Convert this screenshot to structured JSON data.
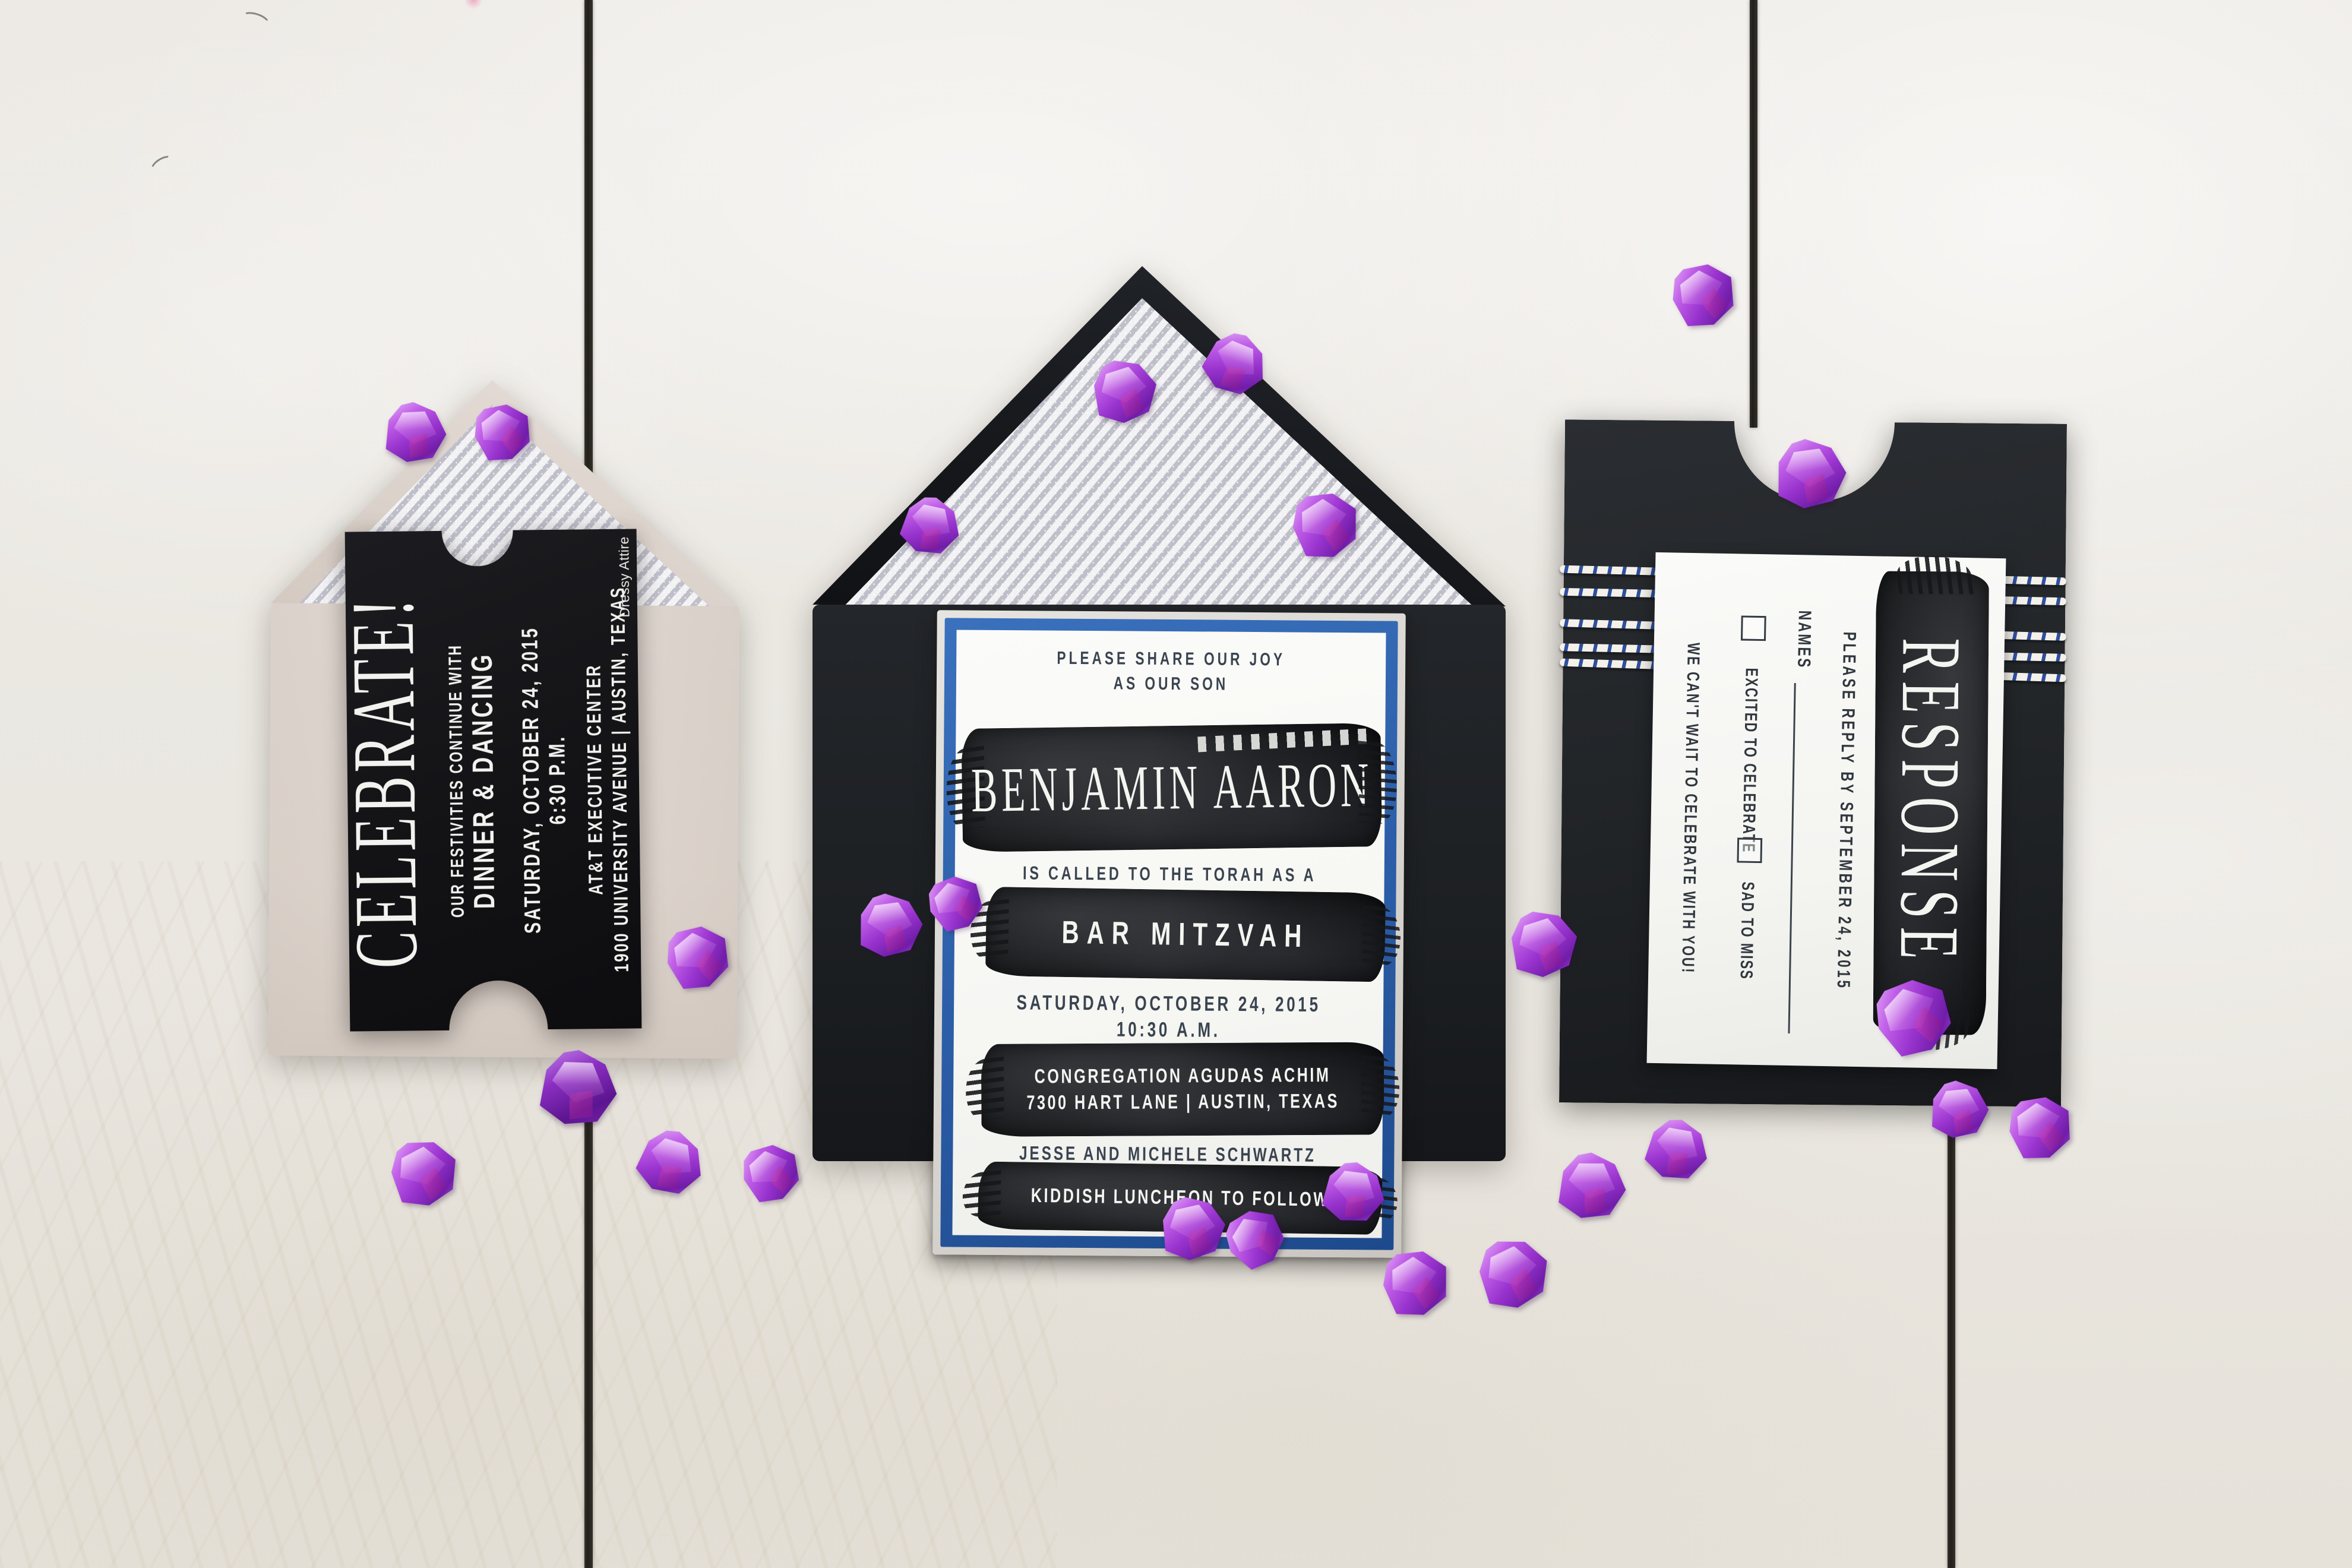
{
  "celebrate_card": {
    "title": "CELEBRATE!",
    "line1": "OUR FESTIVITIES CONTINUE WITH",
    "line2": "DINNER & DANCING",
    "line3": "SATURDAY, OCTOBER 24, 2015",
    "line4": "6:30 P.M.",
    "line5": "AT&T EXECUTIVE CENTER",
    "line6": "1900 UNIVERSITY AVENUE | AUSTIN, TEXAS",
    "note": "Dressy Attire"
  },
  "invitation_card": {
    "intro1": "PLEASE SHARE OUR JOY",
    "intro2": "AS OUR SON",
    "name": "BENJAMIN AARON",
    "called": "IS CALLED TO THE TORAH AS A",
    "event": "BAR MITZVAH",
    "date": "SATURDAY, OCTOBER 24, 2015",
    "time": "10:30 A.M.",
    "venue1": "CONGREGATION AGUDAS ACHIM",
    "venue2": "7300 HART LANE | AUSTIN, TEXAS",
    "hosts": "JESSE AND MICHELE SCHWARTZ",
    "footer": "KIDDISH LUNCHEON TO FOLLOW"
  },
  "response_card": {
    "title": "RESPONSE",
    "reply_by": "PLEASE REPLY BY SEPTEMBER 24, 2015",
    "names_label": "NAMES",
    "option1": "EXCITED TO CELEBRATE",
    "option2": "SAD TO MISS",
    "footer": "WE CAN'T WAIT TO CELEBRATE WITH YOU!"
  },
  "theme": {
    "tile": "#ebe8e2",
    "grout": "#211f1b",
    "envelope_cream": "#dcd3cc",
    "envelope_black": "#1d2023",
    "sleeve": "#222528",
    "ticket": "#131316",
    "mat_silver": "#d7d4cf",
    "frame_blue": "#2b5ca6",
    "card_white": "#f6f6f3",
    "ink": "#3a4450",
    "brush_black": "#151618",
    "liner_silver": "#bfbfca",
    "twine_blue": "#2f4f9e",
    "twine_white": "#f4f1ea",
    "gem_purple": "#9a34cf"
  }
}
